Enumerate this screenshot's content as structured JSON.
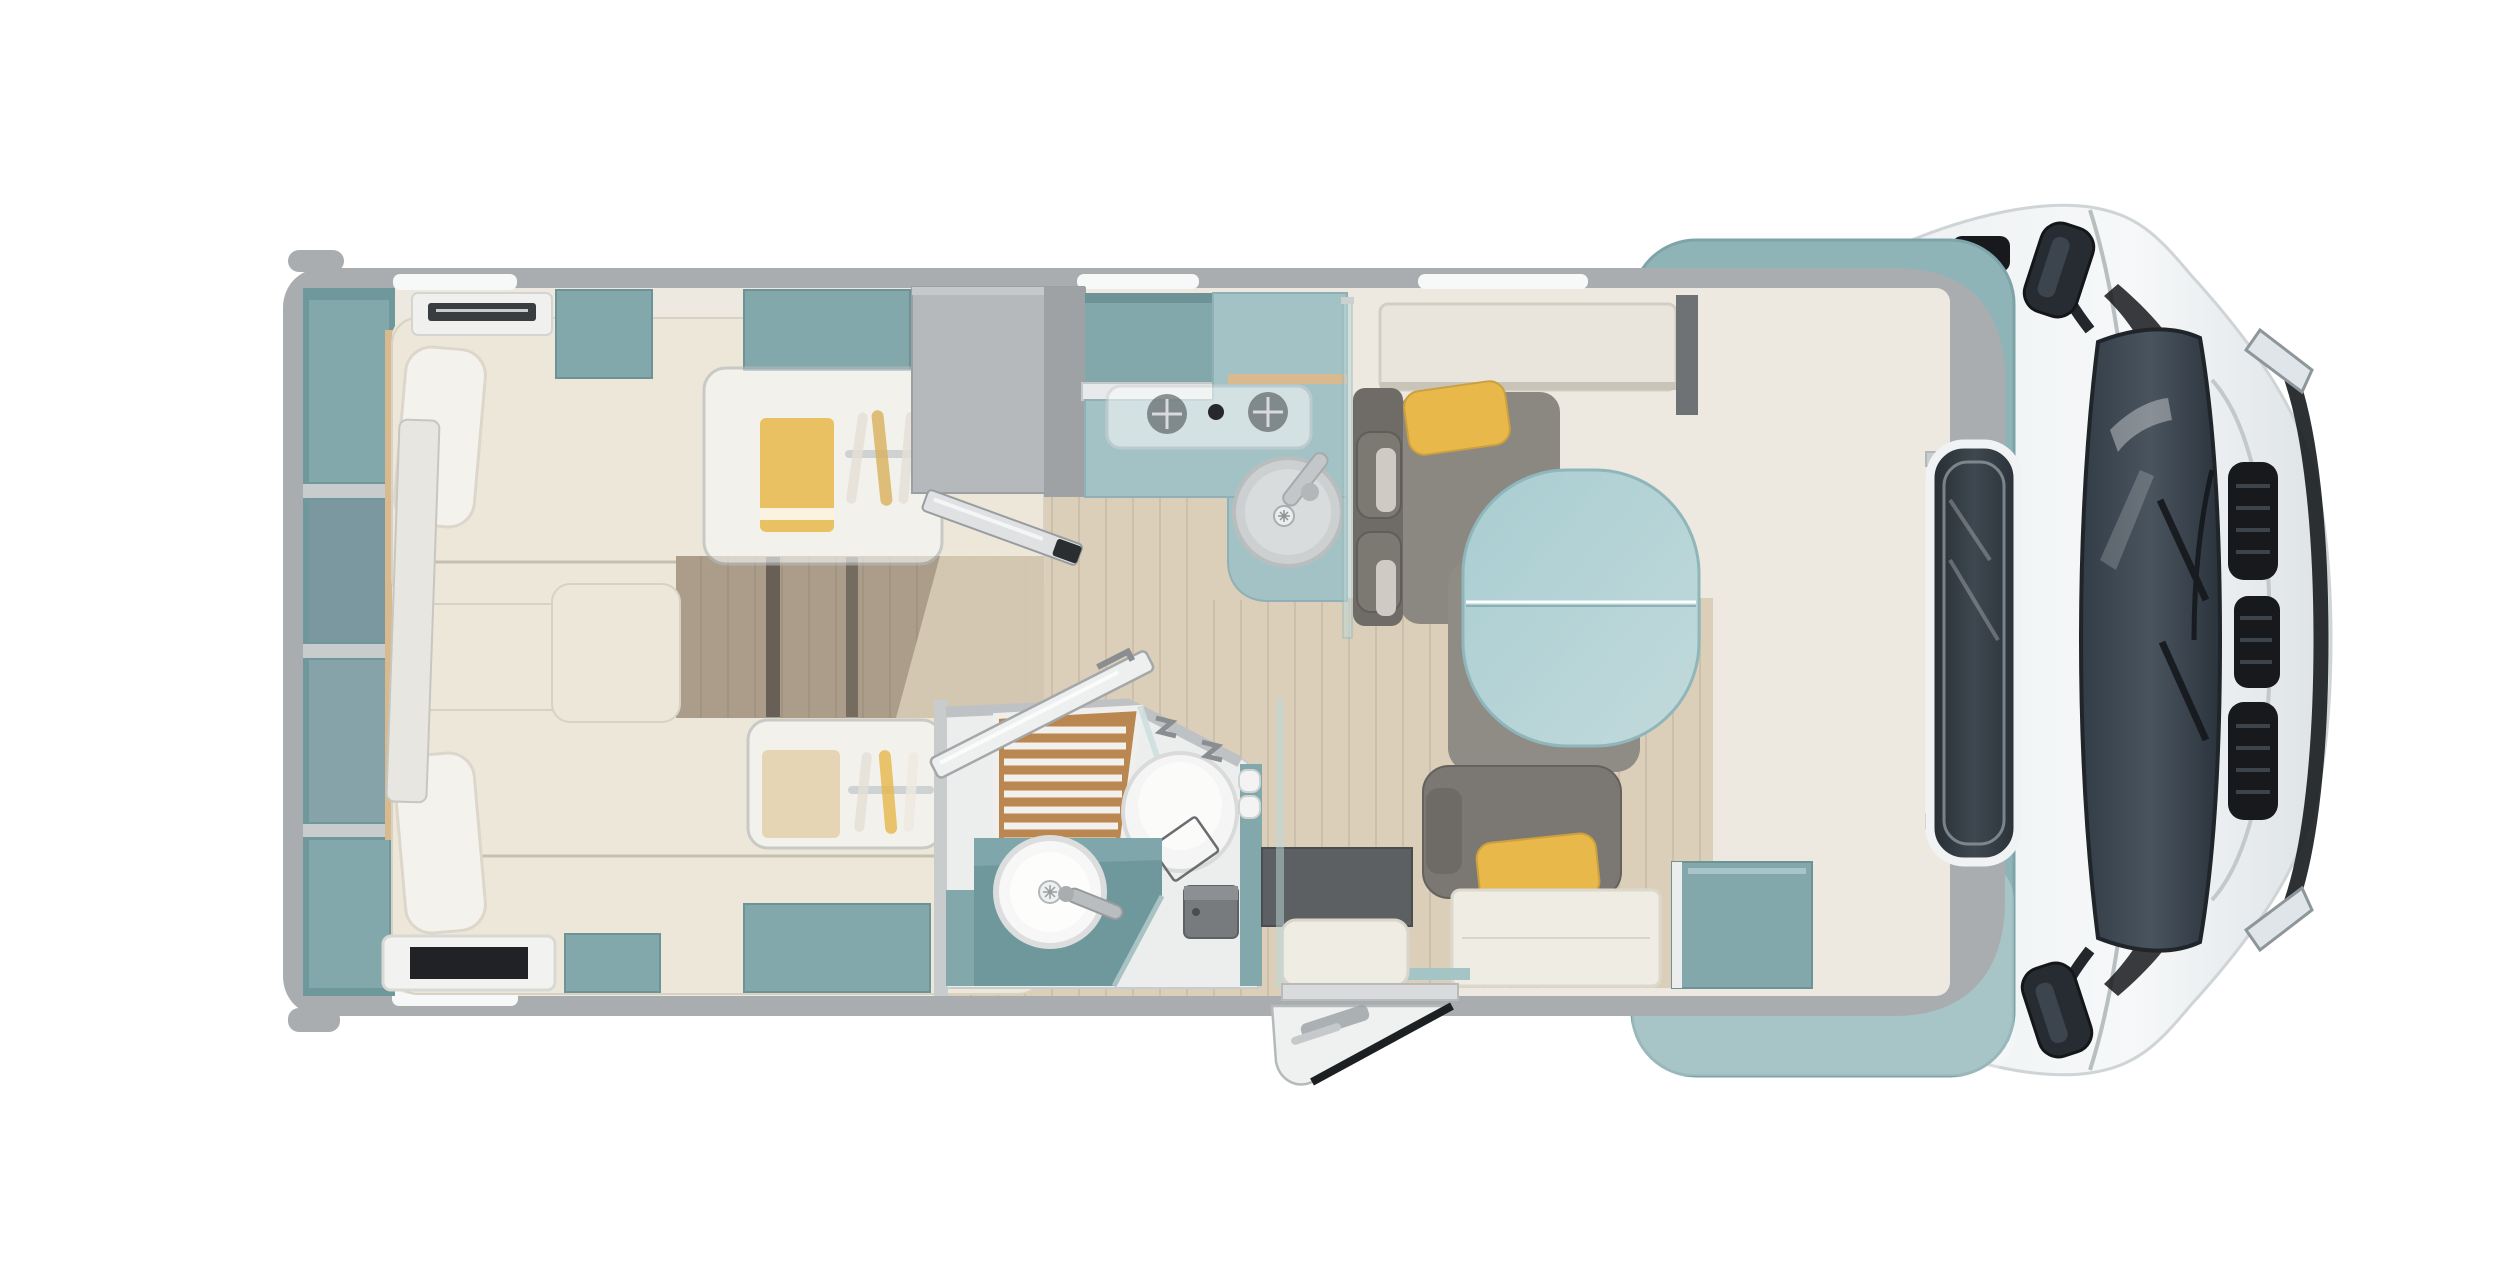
{
  "meta": {
    "description": "Top-down 3D rendered floor plan of a motorhome / RV with rear twin beds, mid wardrobe and kitchen, bathroom with shower and toilet, dinette with split oval table, swiveled cab seats and white driver cab with windshield",
    "visible_text": []
  },
  "colors": {
    "bg": "#ffffff",
    "wall": "#aaadaf",
    "wallLight": "#c9cccd",
    "wallDark": "#8e9193",
    "windowStrip": "#f7f8f8",
    "interiorBase": "#ede9e0",
    "teal": "#82a8ab",
    "tealDark": "#6f989c",
    "tealLight": "#a3c2c6",
    "tealPale": "#bdd2d5",
    "cabTeal": "#8fb4b8",
    "cream": "#e9e5dc",
    "creamDark": "#d6d1c5",
    "creamD2": "#c9c4b7",
    "bedCream": "#ede7da",
    "pillow": "#f4f2ec",
    "wood": "#dbcfba",
    "woodDark": "#ab9d89",
    "woodTrim": "#d9b98e",
    "showerWood": "#b9874f",
    "sofa": "#8b8781",
    "sofaDark": "#6f6b66",
    "carpet": "#75777a",
    "seat": "#6b6862",
    "seatDark": "#555249",
    "yellow": "#e8b84b",
    "tableTeal": "#a9cdd1",
    "tableTealLight": "#c2dadc",
    "chrome": "#c3c7c9",
    "steel": "#9fa2a4",
    "glass": "#bed7d7",
    "cabWhite": "#f3f5f6",
    "cabShade": "#dadfe2",
    "windshield": "#414b55",
    "windshieldDark": "#20252a",
    "black": "#17191c",
    "basinWhite": "#f6f7f6",
    "frost": "#f6f8f8"
  },
  "vehicle": {
    "view": "top-down",
    "zones": [
      "rear-bedroom",
      "wardrobe",
      "kitchen",
      "bathroom",
      "dinette",
      "entry",
      "cab"
    ],
    "furniture": [
      "rear-shelving",
      "twin-bed-top",
      "twin-bed-bottom",
      "bed-pillow",
      "overhead-locker-top",
      "overhead-locker-bottom",
      "bedroom-step",
      "roof-ac-unit",
      "bed-skylight",
      "dresser",
      "dresser-door-open",
      "kitchen-counter",
      "hob",
      "kitchen-sink",
      "kitchen-faucet",
      "splash-glass",
      "overhead-locker-dinette",
      "dinette-bench",
      "dinette-side-seat",
      "dinette-table",
      "yellow-cushion",
      "shower",
      "toilet",
      "washbasin",
      "vanity",
      "bathroom-door-open",
      "water-heater",
      "boiler-bottles",
      "entry-door-open",
      "entry-step",
      "cab-seat-top",
      "cab-seat-bottom",
      "cab-carpet",
      "over-cab-skylight",
      "cab-body",
      "windshield",
      "hood-grille",
      "headlight",
      "side-mirror-top",
      "side-mirror-bottom",
      "front-wheel"
    ]
  }
}
